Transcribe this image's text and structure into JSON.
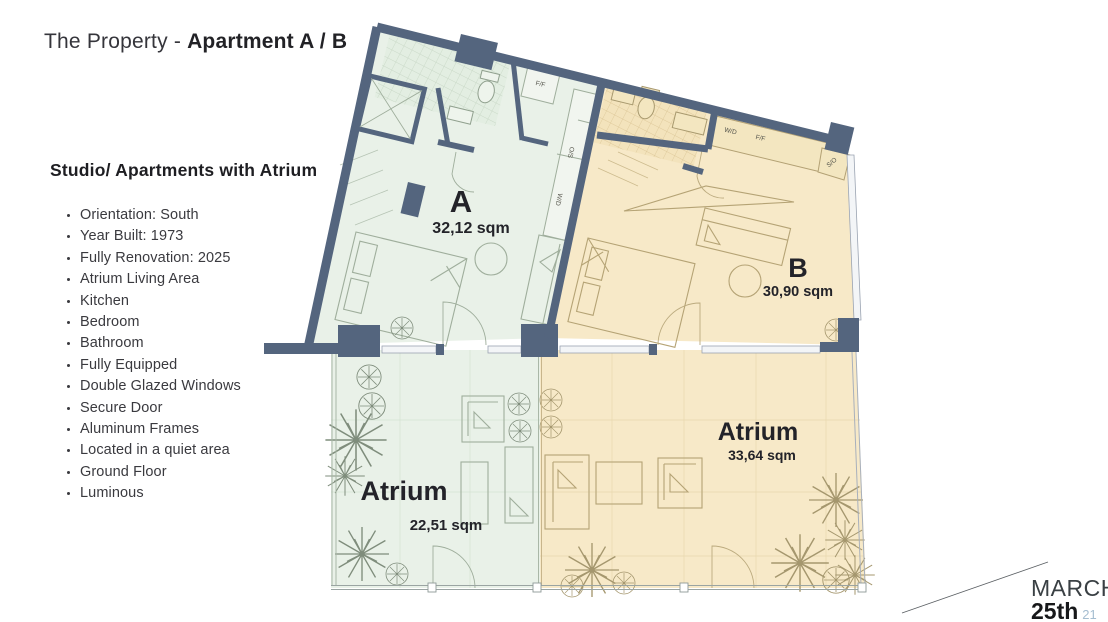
{
  "slide": {
    "title_prefix": "The Property - ",
    "title_bold": "Apartment A / B"
  },
  "details": {
    "heading": "Studio/ Apartments with Atrium",
    "features": [
      "Orientation: South",
      "Year Built: 1973",
      "Fully Renovation: 2025",
      "Atrium Living Area",
      "Kitchen",
      "Bedroom",
      "Bathroom",
      "Fully Equipped",
      "Double Glazed Windows",
      "Secure Door",
      "Aluminum Frames",
      "Located in a quiet area",
      "Ground Floor",
      "Luminous"
    ]
  },
  "floorplan": {
    "units": [
      {
        "name": "Apartment A",
        "label": "A",
        "area": "32,12 sqm",
        "fill": "#e9f1e8"
      },
      {
        "name": "Apartment B",
        "label": "B",
        "area": "30,90 sqm",
        "fill": "#f7e9c8"
      },
      {
        "name": "Atrium of A",
        "label": "Atrium",
        "area": "22,51 sqm",
        "fill": "#e9f1e8"
      },
      {
        "name": "Atrium of B",
        "label": "Atrium",
        "area": "33,64 sqm",
        "fill": "#f7e9c8"
      }
    ],
    "appliances": {
      "a_ff": "F/F",
      "a_os": "O/S",
      "a_wd": "W/D",
      "b_wd": "W/D",
      "b_ff": "F/F",
      "b_so": "S/O"
    },
    "colors": {
      "wall": "#54657e",
      "apartment_a_fill": "#e9f1e8",
      "apartment_b_fill": "#f7e9c8",
      "label_text": "#232329"
    }
  },
  "footer": {
    "month": "MARCH",
    "day": "25th",
    "year": "21"
  }
}
